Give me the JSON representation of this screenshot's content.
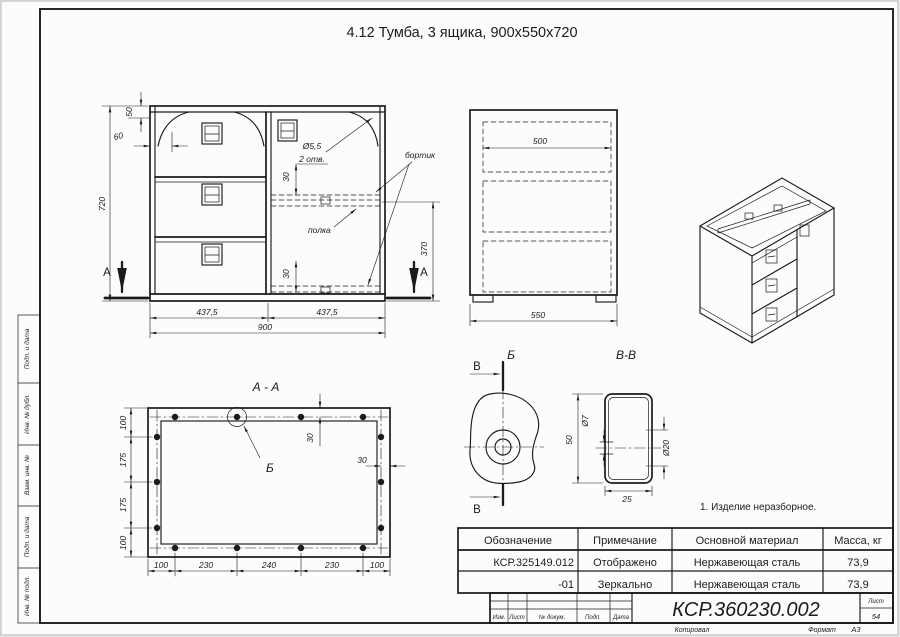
{
  "colors": {
    "paper": "#fcfcfb",
    "line": "#1b1b1b",
    "background": "#e9e9e7"
  },
  "sheet": {
    "title": "4.12 Тумба, 3 ящика, 900х550х720",
    "note": "1. Изделие неразборное."
  },
  "front_view": {
    "section_letter": "А",
    "dim_720": "720",
    "dim_50": "50",
    "dim_60": "60",
    "dim_437_left": "437,5",
    "dim_437_right": "437,5",
    "dim_900": "900",
    "dim_30_upper": "30",
    "dim_30_lower": "30",
    "dim_370": "370",
    "hole_dia": "Ø5,5",
    "hole_qty": "2 отв.",
    "label_bortik": "бортик",
    "label_polka": "полка"
  },
  "side_view": {
    "dim_500": "500",
    "dim_550": "550"
  },
  "section_aa": {
    "title": "А - А",
    "detail_letter": "Б",
    "dims_vertical": [
      "100",
      "175",
      "175",
      "100"
    ],
    "dims_horizontal": [
      "100",
      "230",
      "240",
      "230",
      "100"
    ],
    "dim_30_top": "30",
    "dim_30_right": "30"
  },
  "detail_b": {
    "title": "Б",
    "section_letter_top": "В",
    "section_letter_bottom": "В"
  },
  "section_vv": {
    "title": "В-В",
    "dim_50": "50",
    "dim_25": "25",
    "dim_d7": "Ø7",
    "dim_d20": "Ø20"
  },
  "spec_table": {
    "headers": [
      "Обозначение",
      "Примечание",
      "Основной материал",
      "Масса, кг"
    ],
    "rows": [
      [
        "КСР.325149.012",
        "Отображено",
        "Нержавеющая сталь",
        "73,9"
      ],
      [
        "-01",
        "Зеркально",
        "Нержавеющая сталь",
        "73,9"
      ]
    ]
  },
  "title_block": {
    "doc_number": "КСР.360230.002",
    "columns": [
      "Изм.",
      "Лист",
      "№ докум.",
      "Подп.",
      "Дата"
    ],
    "sheet_label": "Лист",
    "sheet_number": "54",
    "copied_label": "Копировал",
    "format_label": "Формат",
    "format_value": "А3"
  },
  "frame_margin_labels": [
    "Подп. и дата",
    "Инв. № дубл.",
    "Взам. инв. №",
    "Подп. и дата",
    "Инв. № подл."
  ]
}
